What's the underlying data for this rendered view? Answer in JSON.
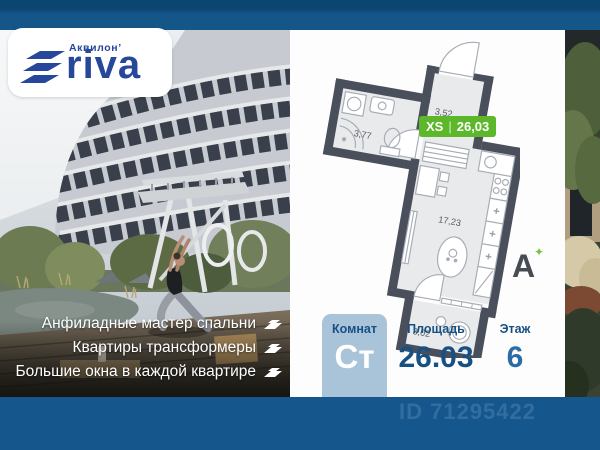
{
  "brand": {
    "name": "Аквилон’",
    "product": "riva",
    "color": "#27479a"
  },
  "plan": {
    "size_label": "XS",
    "separator": "|",
    "total_area": "26,03",
    "badge_color": "#5cb72b",
    "room_areas": [
      "3,77",
      "3,52",
      "17,23",
      "3,02"
    ]
  },
  "energy": {
    "letter": "А",
    "plus_icon": "✦",
    "plus_color": "#7cc242"
  },
  "features": [
    "Анфиладные мастер спальни",
    "Квартиры трансформеры",
    "Большие окна в каждой квартире"
  ],
  "summary": {
    "rooms": {
      "label": "Комнат",
      "value": "Ст"
    },
    "area": {
      "label": "Площадь",
      "value": "26.03"
    },
    "floor": {
      "label": "Этаж",
      "value": "6"
    }
  },
  "listing_id": "ID 71295422",
  "colors": {
    "top_bar": "#11517f",
    "bottom_bar": "#15568c",
    "navy": "#175083",
    "rooms_box": "#a9c3d9",
    "wall": "#4a4f5c"
  }
}
